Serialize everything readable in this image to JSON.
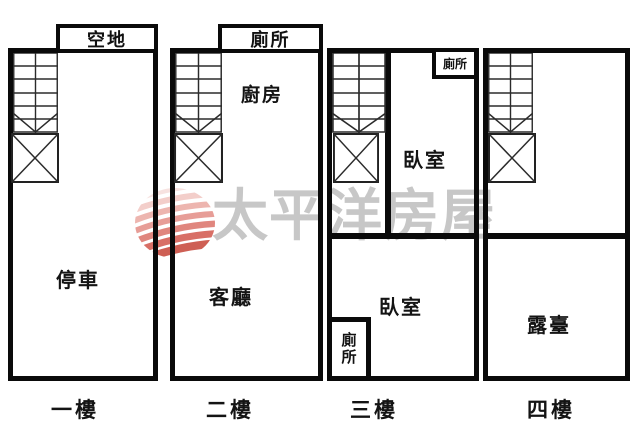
{
  "watermark": {
    "brand_text": "太平洋房屋",
    "text_color": "#c7c7c7",
    "logo_palette": [
      "#f6dedb",
      "#f2c6c1",
      "#eba9a2",
      "#e38d85",
      "#db7168",
      "#d2564c",
      "#c64437"
    ]
  },
  "units": [
    {
      "floor_label": "一樓",
      "annex_label": "空地",
      "rooms": [
        {
          "name": "停車"
        }
      ]
    },
    {
      "floor_label": "二樓",
      "annex_label": "廁所",
      "rooms": [
        {
          "name": "廚房"
        },
        {
          "name": "客廳"
        }
      ]
    },
    {
      "floor_label": "三樓",
      "rooms": [
        {
          "name": "臥室"
        },
        {
          "name": "廁所"
        },
        {
          "name": "臥室"
        },
        {
          "name": "廁所"
        }
      ]
    },
    {
      "floor_label": "四樓",
      "rooms": [
        {
          "name": "露臺"
        }
      ]
    }
  ]
}
